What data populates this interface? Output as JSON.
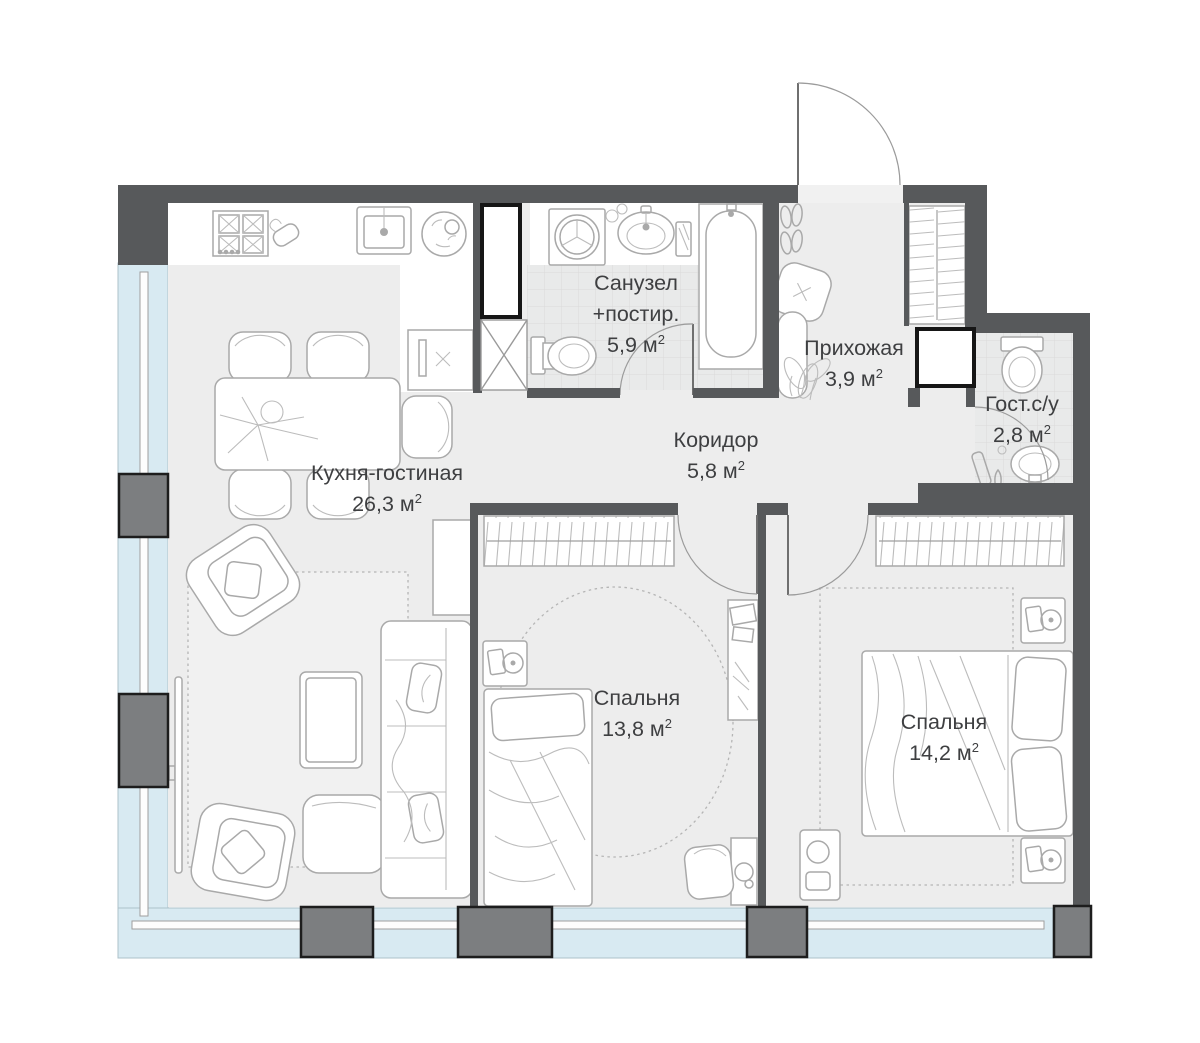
{
  "rooms": [
    {
      "id": "kitchen-living-room",
      "name": "Кухня-гостиная",
      "area": "26,3"
    },
    {
      "id": "bathroom-laundry",
      "name": "Санузел",
      "name2": "+постир.",
      "area": "5,9"
    },
    {
      "id": "hallway",
      "name": "Прихожая",
      "area": "3,9"
    },
    {
      "id": "corridor",
      "name": "Коридор",
      "area": "5,8"
    },
    {
      "id": "guest-bathroom",
      "name": "Гост.с/у",
      "area": "2,8"
    },
    {
      "id": "bedroom-1",
      "name": "Спальня",
      "area": "13,8"
    },
    {
      "id": "bedroom-2",
      "name": "Спальня",
      "area": "14,2"
    }
  ],
  "units": {
    "unit": "м",
    "sup": "2"
  },
  "colors": {
    "wall": "#57595b",
    "pillar": "#7c7e80",
    "glazing": "#d8eaf2",
    "floor": "#ededed",
    "furniture_line": "#a9a9a9",
    "text": "#3e3f41"
  },
  "icons": [
    "stove-icon",
    "oven-mitt-icon",
    "kitchen-sink-icon",
    "dish-icon",
    "dishwasher-icon",
    "dining-table-icon",
    "chair-icon",
    "tv-icon",
    "armchair-icon",
    "coffee-table-icon",
    "ottoman-icon",
    "sofa-icon",
    "side-table-icon",
    "rug",
    "washing-machine-icon",
    "bathroom-sink-icon",
    "towel-icon",
    "bathtub-icon",
    "toilet-icon",
    "wardrobe-icon",
    "mirror-icon",
    "pouf-icon",
    "plant-icon",
    "shoes-icon",
    "bed-icon",
    "nightstand-icon",
    "desk-icon",
    "office-desk-icon",
    "dressing-table-icon",
    "cleaning-supplies-icon",
    "ventilation-shaft-icon",
    "door-arc",
    "entry-door"
  ]
}
